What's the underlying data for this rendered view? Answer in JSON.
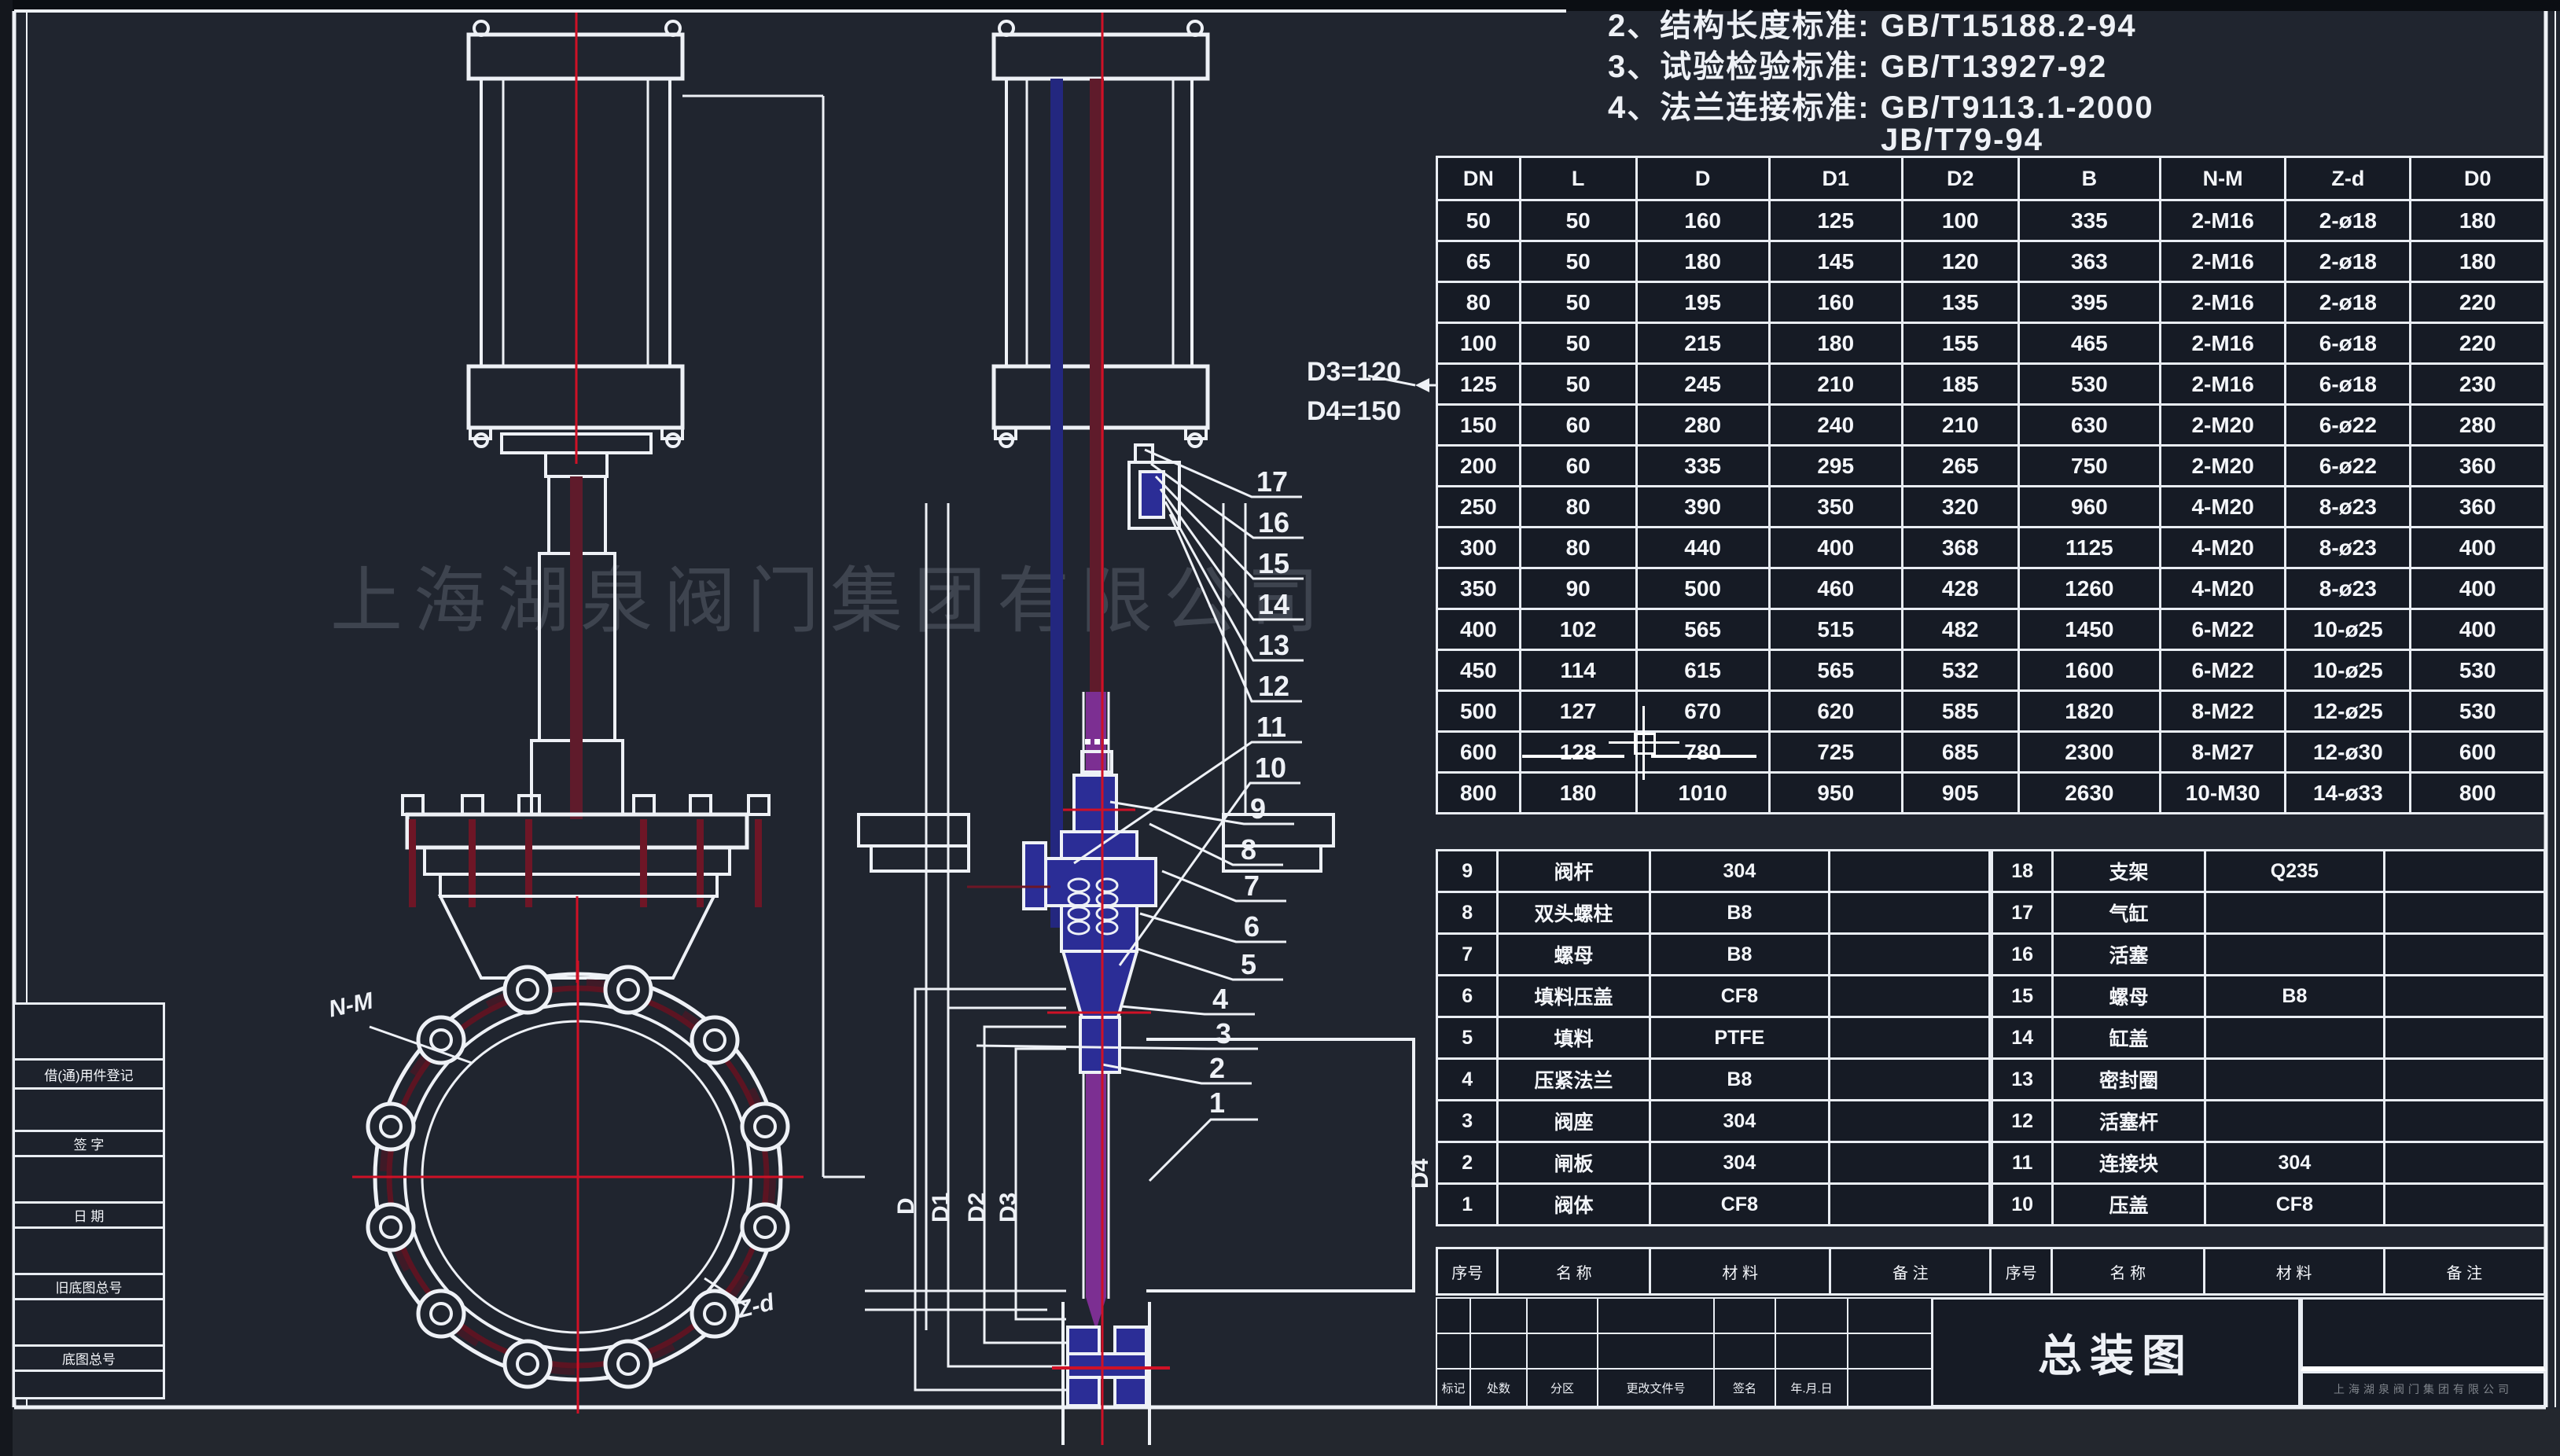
{
  "colors": {
    "line": "#eef1f6",
    "accent_red": "#cf1126",
    "dark_red": "#6e1626",
    "maroon_stem": "#5f1b2b",
    "blue_part": "#2b2d96",
    "purple_gate": "#7c2f92",
    "cell_bg": "#161b25",
    "sheet_bg": "#20252f"
  },
  "watermark": "上海湖泉阀门集团有限公司",
  "notes": {
    "line1": "2、结构长度标准:  GB/T15188.2-94",
    "line2": "3、试验检验标准:  GB/T13927-92",
    "line3": "4、法兰连接标准:  GB/T9113.1-2000",
    "line4": "JB/T79-94"
  },
  "annotations": {
    "d3": "D3=120",
    "d4": "D4=150",
    "nm": "N-M",
    "zd": "Z-d"
  },
  "section_dims": {
    "left": [
      "D",
      "D1",
      "D2",
      "D3"
    ],
    "right": "D4"
  },
  "callouts": [
    "17",
    "16",
    "15",
    "14",
    "13",
    "12",
    "11",
    "10",
    "9",
    "8",
    "7",
    "6",
    "5",
    "4",
    "3",
    "2",
    "1"
  ],
  "dim_table": {
    "header_rows": [
      [
        "DN",
        "L",
        "D",
        "D1",
        "D2",
        "B",
        "N-M",
        "Z-d",
        "D0"
      ]
    ],
    "rows": [
      [
        "50",
        "50",
        "160",
        "125",
        "100",
        "335",
        "2-M16",
        "2-ø18",
        "180"
      ],
      [
        "65",
        "50",
        "180",
        "145",
        "120",
        "363",
        "2-M16",
        "2-ø18",
        "180"
      ],
      [
        "80",
        "50",
        "195",
        "160",
        "135",
        "395",
        "2-M16",
        "2-ø18",
        "220"
      ],
      [
        "100",
        "50",
        "215",
        "180",
        "155",
        "465",
        "2-M16",
        "6-ø18",
        "220"
      ],
      [
        "125",
        "50",
        "245",
        "210",
        "185",
        "530",
        "2-M16",
        "6-ø18",
        "230"
      ],
      [
        "150",
        "60",
        "280",
        "240",
        "210",
        "630",
        "2-M20",
        "6-ø22",
        "280"
      ],
      [
        "200",
        "60",
        "335",
        "295",
        "265",
        "750",
        "2-M20",
        "6-ø22",
        "360"
      ],
      [
        "250",
        "80",
        "390",
        "350",
        "320",
        "960",
        "4-M20",
        "8-ø23",
        "360"
      ],
      [
        "300",
        "80",
        "440",
        "400",
        "368",
        "1125",
        "4-M20",
        "8-ø23",
        "400"
      ],
      [
        "350",
        "90",
        "500",
        "460",
        "428",
        "1260",
        "4-M20",
        "8-ø23",
        "400"
      ],
      [
        "400",
        "102",
        "565",
        "515",
        "482",
        "1450",
        "6-M22",
        "10-ø25",
        "400"
      ],
      [
        "450",
        "114",
        "615",
        "565",
        "532",
        "1600",
        "6-M22",
        "10-ø25",
        "530"
      ],
      [
        "500",
        "127",
        "670",
        "620",
        "585",
        "1820",
        "8-M22",
        "12-ø25",
        "530"
      ],
      [
        "600",
        "128",
        "780",
        "725",
        "685",
        "2300",
        "8-M27",
        "12-ø30",
        "600"
      ],
      [
        "800",
        "180",
        "1010",
        "950",
        "905",
        "2630",
        "10-M30",
        "14-ø33",
        "800"
      ]
    ]
  },
  "bom": {
    "header_rows": [
      [
        "序号",
        "名  称",
        "材  料",
        "备  注",
        "序号",
        "名  称",
        "材  料",
        "备  注"
      ]
    ],
    "left_rows": [
      [
        "9",
        "阀杆",
        "304",
        ""
      ],
      [
        "8",
        "双头螺柱",
        "B8",
        ""
      ],
      [
        "7",
        "螺母",
        "B8",
        ""
      ],
      [
        "6",
        "填料压盖",
        "CF8",
        ""
      ],
      [
        "5",
        "填料",
        "PTFE",
        ""
      ],
      [
        "4",
        "压紧法兰",
        "B8",
        ""
      ],
      [
        "3",
        "阀座",
        "304",
        ""
      ],
      [
        "2",
        "闸板",
        "304",
        ""
      ],
      [
        "1",
        "阀体",
        "CF8",
        ""
      ]
    ],
    "right_rows": [
      [
        "18",
        "支架",
        "Q235",
        ""
      ],
      [
        "17",
        "气缸",
        "",
        ""
      ],
      [
        "16",
        "活塞",
        "",
        ""
      ],
      [
        "15",
        "螺母",
        "B8",
        ""
      ],
      [
        "14",
        "缸盖",
        "",
        ""
      ],
      [
        "13",
        "密封圈",
        "",
        ""
      ],
      [
        "12",
        "活塞杆",
        "",
        ""
      ],
      [
        "11",
        "连接块",
        "304",
        ""
      ],
      [
        "10",
        "压盖",
        "CF8",
        ""
      ]
    ]
  },
  "title_block": {
    "title": "总装图",
    "footer_labels": [
      "标记",
      "处数",
      "分区",
      "更改文件号",
      "签名",
      "年.月.日"
    ],
    "company_line": "上海湖泉阀门集团有限公司"
  },
  "margin_strip": {
    "labels": [
      "借(通)用件登记",
      "签  字",
      "日  期",
      "旧底图总号",
      "底图总号"
    ]
  }
}
